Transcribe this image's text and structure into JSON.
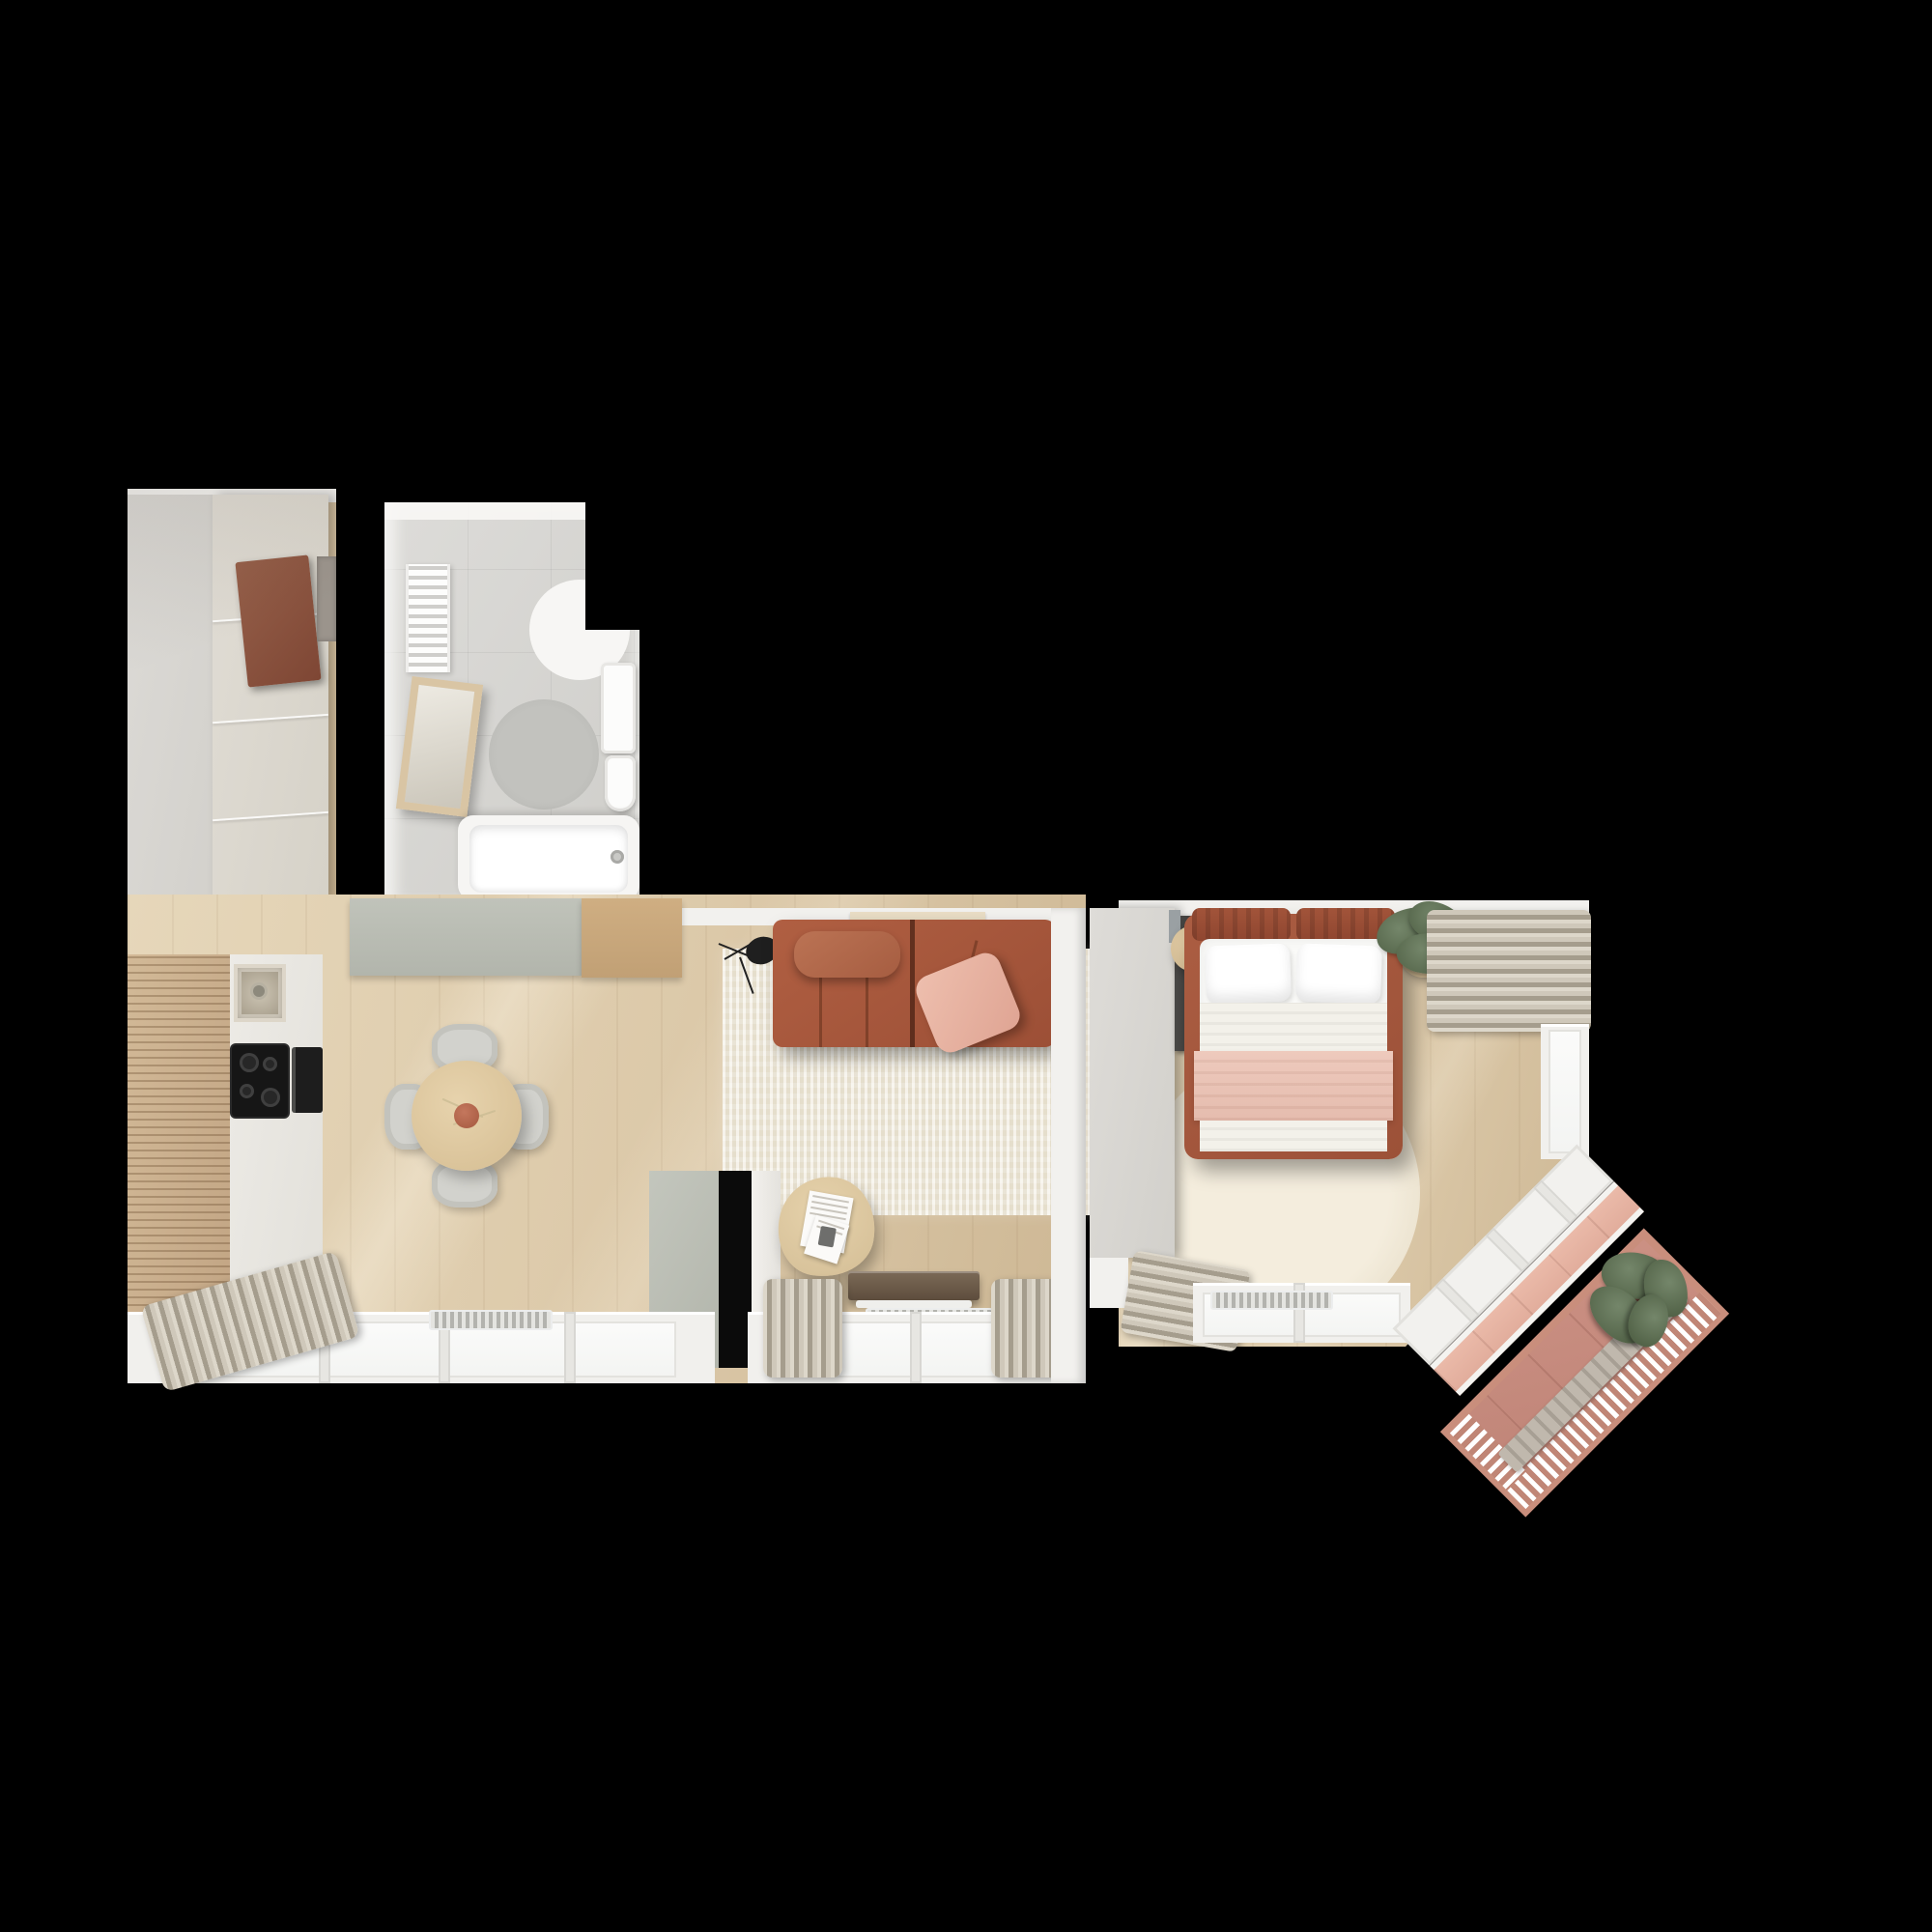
{
  "scene": {
    "title": "Apartment floor plan – top-down 3D render",
    "description": "Photorealistic top view rendering of a one-bedroom apartment on a black background: entry hall with wardrobe, bathroom with tub, open kitchen / dining / living room, bedroom with double bed, and a 45-degree rotated tiled balcony with a plant at the lower right.",
    "background": "black",
    "text_visible_in_image": "none"
  },
  "palette": {
    "bg": "#000000",
    "floor-wood": "#dcc9a9",
    "floor-wood-light": "#e6d7ba",
    "floor-wood-dark": "#cdb794",
    "wall-cap": "#f2f1ee",
    "doormat": "#9b948c",
    "mirror-wood": "#d9c5a4",
    "sofa": "#9c4f36",
    "sofa-light": "#b05f42",
    "pillow-pink": "#e6b3a2",
    "rug-cream": "#ece5d4",
    "bed-frame": "#9c5138",
    "bed-frame-light": "#ab5d42",
    "blanket-pink": "#e9c3b6",
    "balcony-tile": "#c5867b",
    "balcony-edge": "#c98e7c",
    "plant-green": "#5f7456",
    "curtain-beige": "#cfc8ba",
    "counter-gray": "#b8bbb2",
    "counter-wood": "#c9a87d",
    "cabinet-white": "#e9e7e2",
    "appliance-black": "#161616"
  },
  "rooms": [
    {
      "id": "entry-hall",
      "label": "Entry hall",
      "furniture": [
        "built-in wardrobe with panel doors",
        "brown entrance door",
        "gray doormat"
      ]
    },
    {
      "id": "bathroom",
      "label": "Bathroom",
      "furniture": [
        "bathtub with faucet",
        "leaning framed mirror",
        "round gray rug",
        "towel radiator",
        "washbasin cabinet",
        "toilet",
        "corner shower curve"
      ]
    },
    {
      "id": "kitchen",
      "label": "Kitchen",
      "furniture": [
        "slatted wood tall cabinets",
        "white cabinet run",
        "steel sink with tap",
        "black cooktop with four burners",
        "oven",
        "gray worktop",
        "wood worktop"
      ]
    },
    {
      "id": "dining-area",
      "label": "Dining area",
      "furniture": [
        "round wooden table",
        "four gray chairs",
        "terracotta vase with sprigs"
      ]
    },
    {
      "id": "living-area",
      "label": "Living room",
      "furniture": [
        "terracotta modular sofa with chaise",
        "pink cushion",
        "cream textured rug",
        "black tripod floor lamp",
        "organic wood coffee table with magazines",
        "dark media bench",
        "partition wall stub with black panel",
        "window wall with beige curtains",
        "two radiators"
      ]
    },
    {
      "id": "bedroom",
      "label": "Bedroom",
      "furniture": [
        "double bed with terracotta frame",
        "two white pillows",
        "white duvet",
        "pink blanket",
        "round cream rug",
        "white closet with dark sliding door",
        "round wooden bedside table",
        "side table with green plant",
        "beige gathered curtains",
        "corner bay window with radiator"
      ]
    },
    {
      "id": "balcony",
      "label": "Balcony (rotated 45°)",
      "furniture": [
        "pink tiled floor",
        "slatted railing",
        "long bench",
        "large potted plant"
      ]
    }
  ]
}
